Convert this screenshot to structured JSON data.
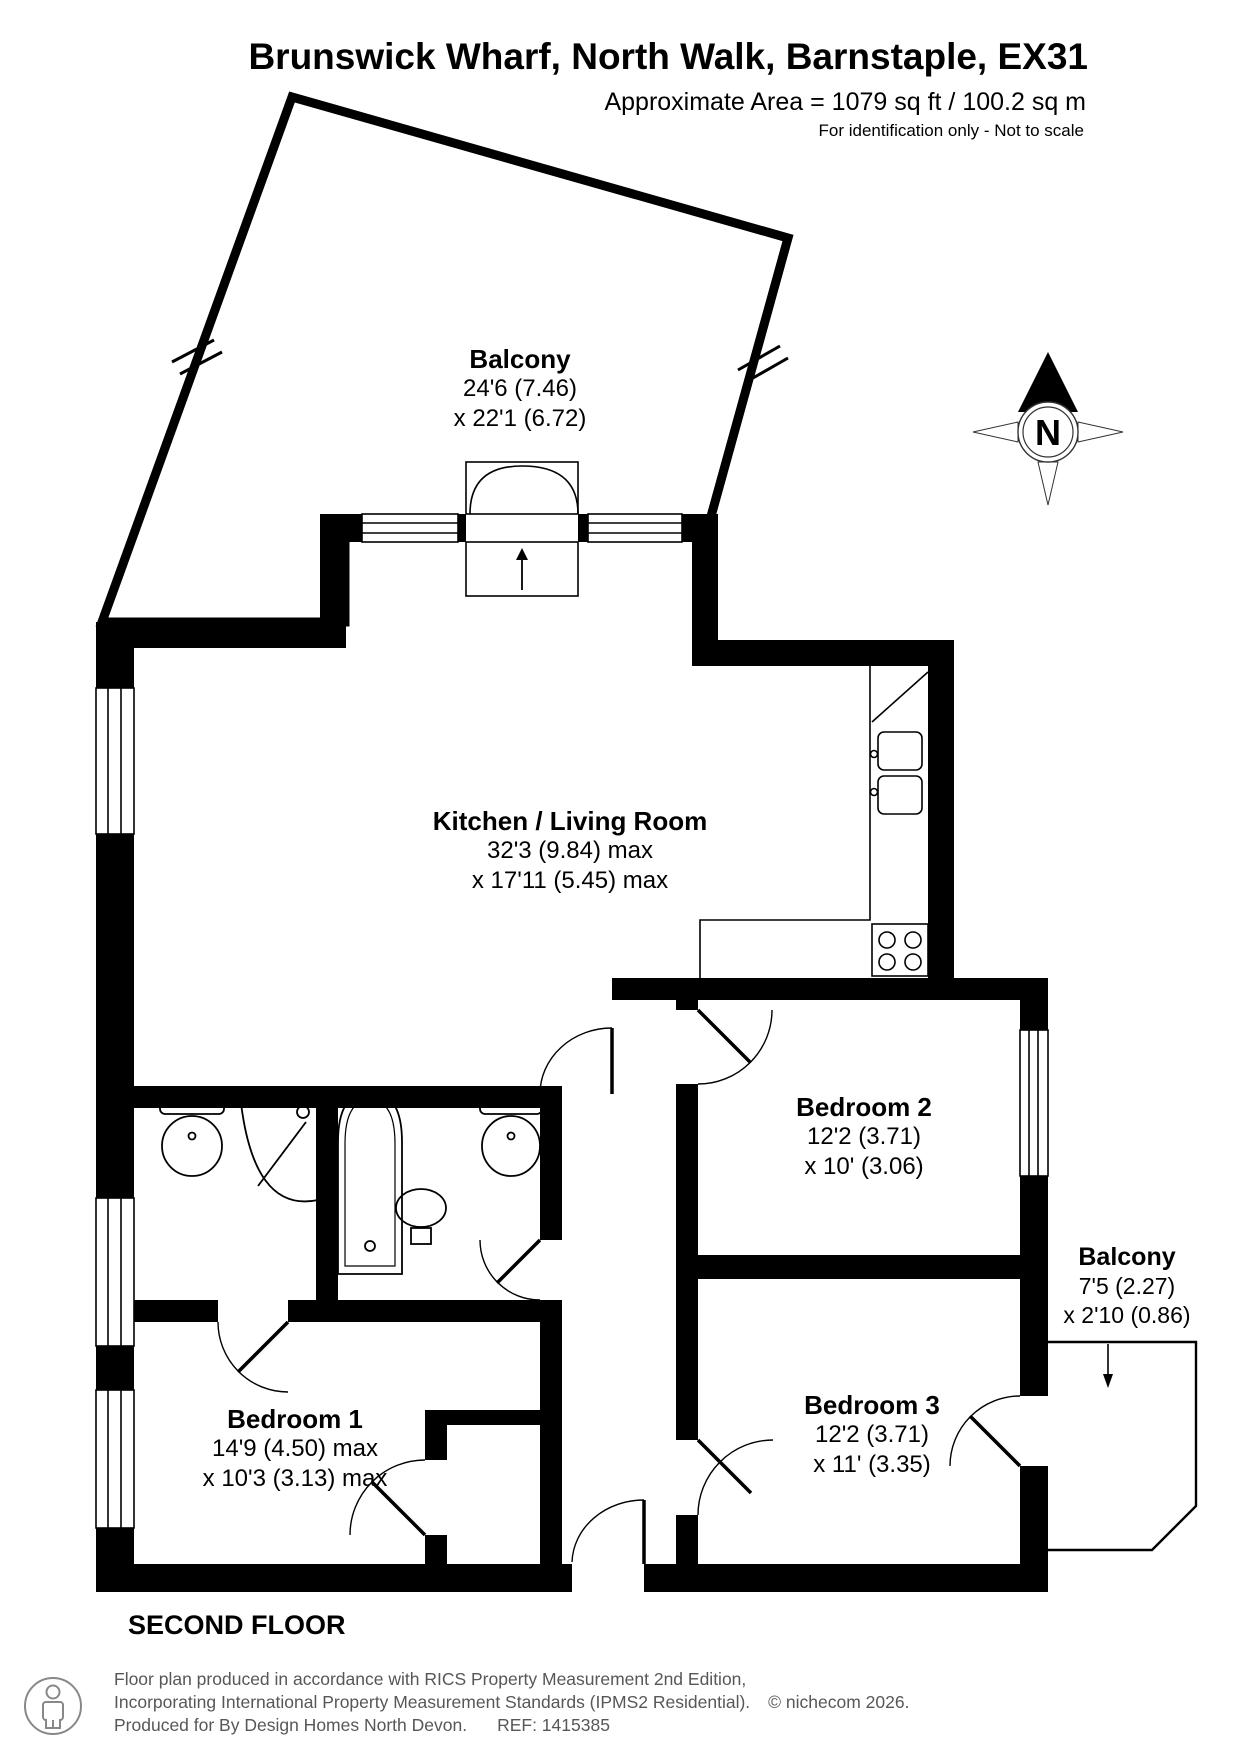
{
  "header": {
    "title": "Brunswick Wharf, North Walk, Barnstaple, EX31",
    "area_line": "Approximate Area = 1079 sq ft / 100.2 sq m",
    "disclaimer": "For identification only - Not to scale"
  },
  "compass": {
    "label": "N"
  },
  "rooms": [
    {
      "id": "balcony-top",
      "name": "Balcony",
      "dim1": "24'6 (7.46)",
      "dim2": "x 22'1 (6.72)"
    },
    {
      "id": "kitchen",
      "name": "Kitchen / Living Room",
      "dim1": "32'3 (9.84) max",
      "dim2": "x 17'11 (5.45) max"
    },
    {
      "id": "bedroom2",
      "name": "Bedroom 2",
      "dim1": "12'2 (3.71)",
      "dim2": "x 10' (3.06)"
    },
    {
      "id": "balcony-right",
      "name": "Balcony",
      "dim1": "7'5 (2.27)",
      "dim2": "x 2'10 (0.86)"
    },
    {
      "id": "bedroom3",
      "name": "Bedroom 3",
      "dim1": "12'2 (3.71)",
      "dim2": "x 11' (3.35)"
    },
    {
      "id": "bedroom1",
      "name": "Bedroom 1",
      "dim1": "14'9 (4.50) max",
      "dim2": "x 10'3 (3.13) max"
    }
  ],
  "floor_label": "SECOND FLOOR",
  "footer": {
    "line1": "Floor plan produced in accordance with RICS Property Measurement 2nd Edition,",
    "line2": "Incorporating International Property Measurement Standards (IPMS2 Residential).",
    "copyright": "© nichecom 2026.",
    "line3": "Produced for By Design Homes North Devon.",
    "ref": "REF: 1415385"
  },
  "colors": {
    "wall": "#000000",
    "footer_text": "#575757"
  }
}
